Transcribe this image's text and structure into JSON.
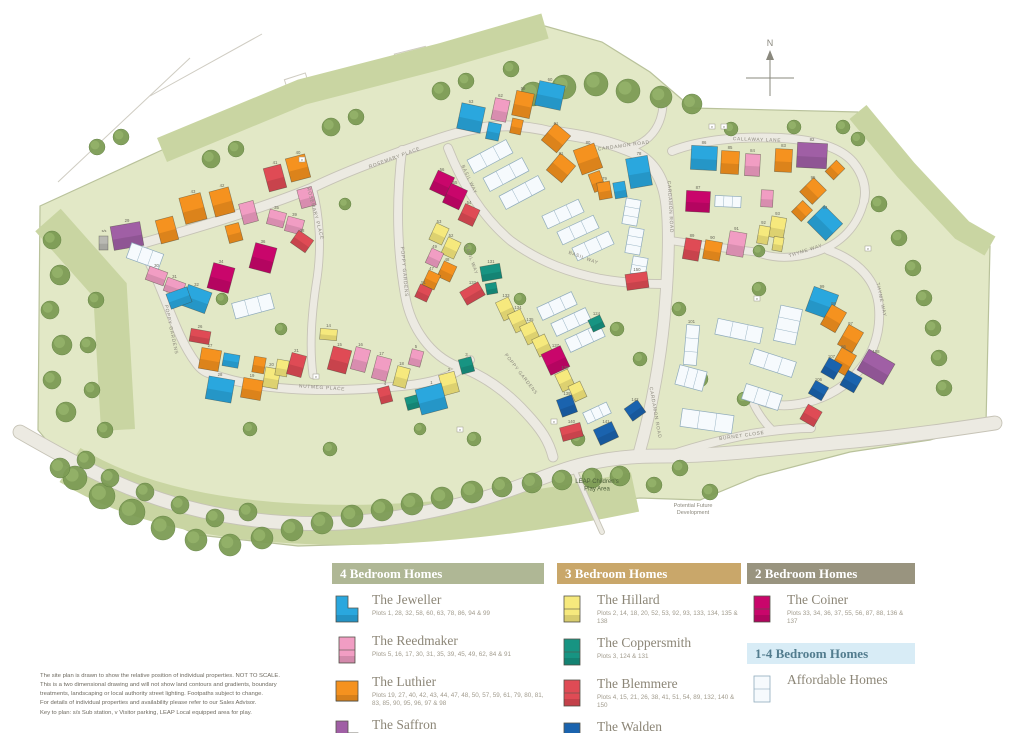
{
  "compass": {
    "label": "N"
  },
  "colors": {
    "J": "#2aa7de",
    "R": "#f19dc3",
    "L": "#f5921f",
    "S": "#a05fa5",
    "H": "#f6e97d",
    "T": "#179482",
    "B": "#df4b55",
    "W": "#1a63ae",
    "C": "#c9066b",
    "A": "#f6fafd",
    "G": "#b9b9b3"
  },
  "map": {
    "street_labels": [
      {
        "t": "ROSEMARY PLACE",
        "x": 395,
        "y": 159,
        "r": -20
      },
      {
        "t": "ROSEMARY PLACE",
        "x": 314,
        "y": 214,
        "r": 75
      },
      {
        "t": "POPPY GARDENS",
        "x": 170,
        "y": 330,
        "r": 78
      },
      {
        "t": "POPPY GARDENS",
        "x": 403,
        "y": 272,
        "r": 85
      },
      {
        "t": "POPPY GARDENS",
        "x": 520,
        "y": 375,
        "r": 52
      },
      {
        "t": "NUTMEG PLACE",
        "x": 322,
        "y": 389,
        "r": 4
      },
      {
        "t": "CARDAMON ROAD",
        "x": 624,
        "y": 147,
        "r": -8
      },
      {
        "t": "CARDAMON ROAD",
        "x": 669,
        "y": 207,
        "r": 87
      },
      {
        "t": "CARDAMON ROAD",
        "x": 654,
        "y": 413,
        "r": 80
      },
      {
        "t": "CALLAWAY LANE",
        "x": 757,
        "y": 141,
        "r": 2
      },
      {
        "t": "BASIL WAY",
        "x": 468,
        "y": 180,
        "r": 65
      },
      {
        "t": "BASIL WAY",
        "x": 470,
        "y": 260,
        "r": 70
      },
      {
        "t": "BASIL WAY",
        "x": 583,
        "y": 259,
        "r": 20
      },
      {
        "t": "THYME WAY",
        "x": 806,
        "y": 252,
        "r": -18
      },
      {
        "t": "THYME WAY",
        "x": 880,
        "y": 300,
        "r": 78
      },
      {
        "t": "BURNET CLOSE",
        "x": 742,
        "y": 437,
        "r": -8
      }
    ],
    "area_labels": [
      {
        "lines": [
          "LEAP Children's",
          "Play Area"
        ],
        "x": 597,
        "y": 483,
        "size": 6,
        "color": "#4c5f3a"
      },
      {
        "lines": [
          "Potential Future",
          "Development"
        ],
        "x": 693,
        "y": 507,
        "size": 5.5,
        "color": "#8b887d"
      }
    ],
    "marks": [
      {
        "t": "v",
        "x": 712,
        "y": 127
      },
      {
        "t": "v",
        "x": 724,
        "y": 127
      },
      {
        "t": "v",
        "x": 316,
        "y": 377
      },
      {
        "t": "v",
        "x": 554,
        "y": 422
      },
      {
        "t": "v",
        "x": 757,
        "y": 299
      },
      {
        "t": "v",
        "x": 868,
        "y": 249
      },
      {
        "t": "v",
        "x": 302,
        "y": 160
      },
      {
        "t": "v",
        "x": 460,
        "y": 430
      },
      {
        "t": "s/s",
        "x": 104,
        "y": 231
      }
    ],
    "houses": [
      [
        "S",
        112,
        224,
        30,
        24,
        -10,
        "29"
      ],
      [
        "L",
        158,
        218,
        18,
        24,
        -15,
        ""
      ],
      [
        "L",
        182,
        195,
        22,
        27,
        -15,
        "43"
      ],
      [
        "L",
        212,
        189,
        20,
        26,
        -15,
        "42"
      ],
      [
        "R",
        241,
        202,
        15,
        21,
        -15,
        ""
      ],
      [
        "B",
        266,
        166,
        18,
        24,
        -15,
        "41"
      ],
      [
        "L",
        288,
        156,
        20,
        24,
        -15,
        "40"
      ],
      [
        "R",
        299,
        188,
        15,
        19,
        -15,
        ""
      ],
      [
        "L",
        227,
        224,
        14,
        18,
        -15,
        ""
      ],
      [
        "A",
        128,
        248,
        34,
        16,
        20,
        ""
      ],
      [
        "R",
        147,
        269,
        19,
        14,
        20,
        "30"
      ],
      [
        "R",
        165,
        280,
        19,
        14,
        20,
        "31"
      ],
      [
        "J",
        184,
        288,
        25,
        22,
        20,
        "32"
      ],
      [
        "C",
        210,
        265,
        22,
        26,
        15,
        "34"
      ],
      [
        "C",
        252,
        245,
        22,
        26,
        15,
        "36"
      ],
      [
        "R",
        268,
        211,
        17,
        15,
        15,
        "35"
      ],
      [
        "R",
        286,
        218,
        17,
        15,
        15,
        "39"
      ],
      [
        "B",
        293,
        234,
        18,
        15,
        35,
        "38"
      ],
      [
        "G",
        99,
        236,
        9,
        14,
        0,
        ""
      ],
      [
        "C",
        433,
        173,
        18,
        21,
        25,
        "56"
      ],
      [
        "C",
        446,
        186,
        18,
        21,
        25,
        "55"
      ],
      [
        "B",
        461,
        206,
        16,
        18,
        25,
        "54"
      ],
      [
        "H",
        432,
        225,
        14,
        18,
        25,
        "53"
      ],
      [
        "H",
        444,
        239,
        14,
        18,
        25,
        "52"
      ],
      [
        "R",
        428,
        250,
        13,
        16,
        25,
        "49"
      ],
      [
        "L",
        440,
        263,
        14,
        17,
        25,
        "48"
      ],
      [
        "L",
        425,
        272,
        13,
        16,
        25,
        "47"
      ],
      [
        "B",
        417,
        286,
        13,
        14,
        25,
        "51"
      ],
      [
        "J",
        537,
        83,
        26,
        25,
        12,
        "60"
      ],
      [
        "L",
        514,
        92,
        18,
        25,
        12,
        "59"
      ],
      [
        "R",
        493,
        99,
        15,
        22,
        12,
        "62"
      ],
      [
        "J",
        459,
        105,
        24,
        26,
        12,
        "63"
      ],
      [
        "J",
        487,
        123,
        13,
        17,
        12,
        ""
      ],
      [
        "L",
        511,
        119,
        11,
        15,
        12,
        ""
      ],
      [
        "A",
        468,
        149,
        44,
        15,
        -28,
        ""
      ],
      [
        "A",
        484,
        167,
        44,
        15,
        -28,
        ""
      ],
      [
        "A",
        500,
        185,
        44,
        15,
        -28,
        ""
      ],
      [
        "L",
        546,
        127,
        20,
        22,
        40,
        "61"
      ],
      [
        "L",
        551,
        157,
        20,
        22,
        40,
        "81"
      ],
      [
        "L",
        577,
        146,
        22,
        26,
        -20,
        "80"
      ],
      [
        "L",
        591,
        172,
        12,
        19,
        -20,
        ""
      ],
      [
        "L",
        598,
        182,
        13,
        17,
        -10,
        "79"
      ],
      [
        "J",
        628,
        157,
        22,
        30,
        -10,
        "78"
      ],
      [
        "J",
        614,
        182,
        12,
        16,
        -10,
        ""
      ],
      [
        "A",
        543,
        207,
        40,
        14,
        -25,
        ""
      ],
      [
        "A",
        558,
        223,
        40,
        14,
        -25,
        ""
      ],
      [
        "A",
        573,
        239,
        40,
        14,
        -25,
        ""
      ],
      [
        "A",
        624,
        199,
        15,
        26,
        10,
        ""
      ],
      [
        "A",
        627,
        228,
        15,
        26,
        10,
        ""
      ],
      [
        "A",
        631,
        257,
        15,
        26,
        10,
        ""
      ],
      [
        "T",
        481,
        265,
        20,
        15,
        -10,
        "131"
      ],
      [
        "T",
        486,
        283,
        11,
        11,
        -10,
        ""
      ],
      [
        "B",
        462,
        286,
        21,
        15,
        -30,
        "132"
      ],
      [
        "B",
        626,
        273,
        22,
        16,
        -8,
        "150"
      ],
      [
        "A",
        538,
        299,
        38,
        14,
        -25,
        ""
      ],
      [
        "A",
        552,
        315,
        38,
        14,
        -25,
        ""
      ],
      [
        "A",
        566,
        331,
        38,
        14,
        -25,
        ""
      ],
      [
        "H",
        499,
        299,
        14,
        20,
        -25,
        "133"
      ],
      [
        "H",
        511,
        311,
        14,
        20,
        -25,
        "134"
      ],
      [
        "H",
        523,
        323,
        14,
        20,
        -25,
        "135"
      ],
      [
        "H",
        535,
        336,
        14,
        19,
        -25,
        ""
      ],
      [
        "C",
        545,
        349,
        21,
        23,
        -25,
        "137"
      ],
      [
        "H",
        558,
        371,
        14,
        19,
        -25,
        "138"
      ],
      [
        "H",
        571,
        383,
        13,
        17,
        -25,
        ""
      ],
      [
        "W",
        559,
        397,
        16,
        18,
        -20,
        "139"
      ],
      [
        "B",
        561,
        425,
        21,
        14,
        -15,
        "140"
      ],
      [
        "W",
        596,
        425,
        20,
        17,
        -25,
        "141"
      ],
      [
        "W",
        627,
        403,
        16,
        15,
        -35,
        "142"
      ],
      [
        "A",
        584,
        407,
        26,
        12,
        -25,
        ""
      ],
      [
        "T",
        590,
        317,
        13,
        13,
        -25,
        "124"
      ],
      [
        "B",
        190,
        330,
        20,
        13,
        10,
        "26"
      ],
      [
        "L",
        200,
        349,
        20,
        21,
        10,
        "27"
      ],
      [
        "J",
        223,
        354,
        16,
        13,
        10,
        ""
      ],
      [
        "J",
        207,
        378,
        26,
        23,
        10,
        "28"
      ],
      [
        "L",
        242,
        379,
        20,
        20,
        10,
        "19"
      ],
      [
        "L",
        253,
        357,
        12,
        16,
        10,
        ""
      ],
      [
        "H",
        264,
        368,
        15,
        20,
        10,
        "20"
      ],
      [
        "H",
        276,
        360,
        12,
        16,
        10,
        ""
      ],
      [
        "B",
        289,
        354,
        15,
        22,
        15,
        "21"
      ],
      [
        "H",
        320,
        329,
        17,
        11,
        5,
        "14"
      ],
      [
        "B",
        330,
        348,
        19,
        24,
        15,
        "15"
      ],
      [
        "R",
        353,
        348,
        15,
        23,
        15,
        "16"
      ],
      [
        "R",
        374,
        357,
        15,
        23,
        15,
        "17"
      ],
      [
        "H",
        395,
        367,
        13,
        20,
        15,
        "18"
      ],
      [
        "R",
        410,
        350,
        12,
        16,
        15,
        "5"
      ],
      [
        "H",
        441,
        373,
        16,
        21,
        -15,
        "2"
      ],
      [
        "T",
        460,
        358,
        13,
        15,
        -15,
        "3"
      ],
      [
        "T",
        406,
        396,
        13,
        13,
        -15,
        ""
      ],
      [
        "J",
        418,
        386,
        27,
        26,
        -15,
        "1"
      ],
      [
        "B",
        379,
        387,
        12,
        16,
        -15,
        "4"
      ],
      [
        "J",
        168,
        290,
        22,
        16,
        -20,
        ""
      ],
      [
        "A",
        233,
        298,
        40,
        16,
        -15,
        ""
      ],
      [
        "J",
        691,
        146,
        26,
        24,
        3,
        "86"
      ],
      [
        "L",
        721,
        151,
        18,
        23,
        3,
        "85"
      ],
      [
        "R",
        745,
        154,
        15,
        22,
        3,
        "84"
      ],
      [
        "L",
        775,
        149,
        17,
        23,
        3,
        "83"
      ],
      [
        "S",
        797,
        143,
        30,
        25,
        3,
        "82"
      ],
      [
        "C",
        686,
        191,
        24,
        21,
        3,
        "87"
      ],
      [
        "A",
        715,
        196,
        26,
        11,
        3,
        ""
      ],
      [
        "R",
        761,
        190,
        12,
        17,
        3,
        ""
      ],
      [
        "L",
        829,
        162,
        12,
        16,
        45,
        ""
      ],
      [
        "L",
        804,
        181,
        18,
        20,
        45,
        "95"
      ],
      [
        "L",
        795,
        203,
        14,
        16,
        45,
        ""
      ],
      [
        "J",
        812,
        211,
        26,
        24,
        45,
        "94"
      ],
      [
        "H",
        770,
        217,
        15,
        21,
        10,
        "93"
      ],
      [
        "H",
        758,
        226,
        11,
        18,
        10,
        "92"
      ],
      [
        "H",
        773,
        237,
        10,
        14,
        10,
        ""
      ],
      [
        "R",
        728,
        232,
        17,
        24,
        10,
        "91"
      ],
      [
        "L",
        704,
        241,
        17,
        19,
        10,
        "90"
      ],
      [
        "B",
        684,
        239,
        16,
        21,
        10,
        "89"
      ],
      [
        "J",
        809,
        290,
        26,
        26,
        20,
        "99"
      ],
      [
        "L",
        825,
        307,
        17,
        23,
        30,
        "98"
      ],
      [
        "L",
        842,
        327,
        17,
        23,
        30,
        "97"
      ],
      [
        "L",
        835,
        350,
        17,
        23,
        30,
        "96"
      ],
      [
        "W",
        824,
        360,
        15,
        17,
        30,
        "107"
      ],
      [
        "W",
        843,
        373,
        16,
        17,
        30,
        ""
      ],
      [
        "W",
        811,
        383,
        15,
        15,
        30,
        "106"
      ],
      [
        "S",
        861,
        355,
        30,
        24,
        30,
        "108"
      ],
      [
        "B",
        803,
        407,
        16,
        17,
        30,
        ""
      ],
      [
        "A",
        685,
        325,
        13,
        40,
        5,
        "101"
      ],
      [
        "A",
        677,
        368,
        28,
        20,
        15,
        ""
      ],
      [
        "A",
        716,
        323,
        46,
        16,
        12,
        ""
      ],
      [
        "A",
        751,
        355,
        44,
        16,
        18,
        ""
      ],
      [
        "A",
        777,
        307,
        22,
        36,
        12,
        ""
      ],
      [
        "A",
        681,
        412,
        52,
        18,
        8,
        ""
      ],
      [
        "A",
        743,
        389,
        38,
        16,
        18,
        ""
      ]
    ]
  },
  "legend": {
    "sections": [
      {
        "col": 0,
        "title": "4 Bedroom Homes",
        "bg": "#afb795",
        "light": false,
        "items": [
          {
            "key": "J",
            "shape": "L",
            "name": "The Jeweller",
            "plots": "Plots 1, 28, 32, 58, 60, 63, 78, 86, 94 & 99"
          },
          {
            "key": "R",
            "shape": "tall",
            "name": "The Reedmaker",
            "plots": "Plots 5, 16, 17, 30, 31, 35, 39, 45, 49, 62, 84 & 91"
          },
          {
            "key": "L",
            "shape": "sq",
            "name": "The Luthier",
            "plots": "Plots 19, 27, 40, 42, 43, 44, 47, 48, 50, 57, 59, 61, 79, 80, 81, 83, 85, 90, 95, 96, 97 & 98"
          },
          {
            "key": "S",
            "shape": "L",
            "name": "The Saffron",
            "plots": "Plots 29, 46, 82 & 108"
          }
        ]
      },
      {
        "col": 1,
        "title": "3 Bedroom Homes",
        "bg": "#c9a76a",
        "light": false,
        "items": [
          {
            "key": "H",
            "shape": "tall",
            "name": "The Hillard",
            "plots": "Plots 2, 14, 18, 20, 52, 53, 92, 93, 133, 134, 135 & 138"
          },
          {
            "key": "T",
            "shape": "tall",
            "name": "The Coppersmith",
            "plots": "Plots 3, 124 & 131"
          },
          {
            "key": "B",
            "shape": "tall",
            "name": "The Blemmere",
            "plots": "Plots 4, 15, 21, 26, 38, 41, 51, 54, 89, 132, 140 & 150"
          },
          {
            "key": "W",
            "shape": "tall",
            "name": "The Walden",
            "plots": "Plots 106, 107, 139, 141 & 142"
          }
        ]
      },
      {
        "col": 2,
        "title": "2 Bedroom Homes",
        "bg": "#99947f",
        "light": false,
        "items": [
          {
            "key": "C",
            "shape": "tall",
            "name": "The Coiner",
            "plots": "Plots 33, 34, 36, 37, 55, 56, 87, 88, 136 & 137"
          }
        ]
      },
      {
        "col": 2,
        "title": "1-4 Bedroom Homes",
        "bg": "#d8ecf6",
        "light": true,
        "items": [
          {
            "key": "A",
            "shape": "tall",
            "name": "Affordable Homes",
            "plots": ""
          }
        ]
      }
    ]
  },
  "disclaimer": [
    "The site plan is drawn to show the relative position of individual properties. NOT TO SCALE.",
    "This is a two dimensional drawing and will not show land contours and gradients, boundary",
    "treatments, landscaping or local authority street lighting. Footpaths subject to change.",
    "For details of individual properties and availability please refer to our Sales Advisor.",
    "Key to plan: s/s  Sub station, v  Visitor parking, LEAP  Local equipped area for play."
  ]
}
